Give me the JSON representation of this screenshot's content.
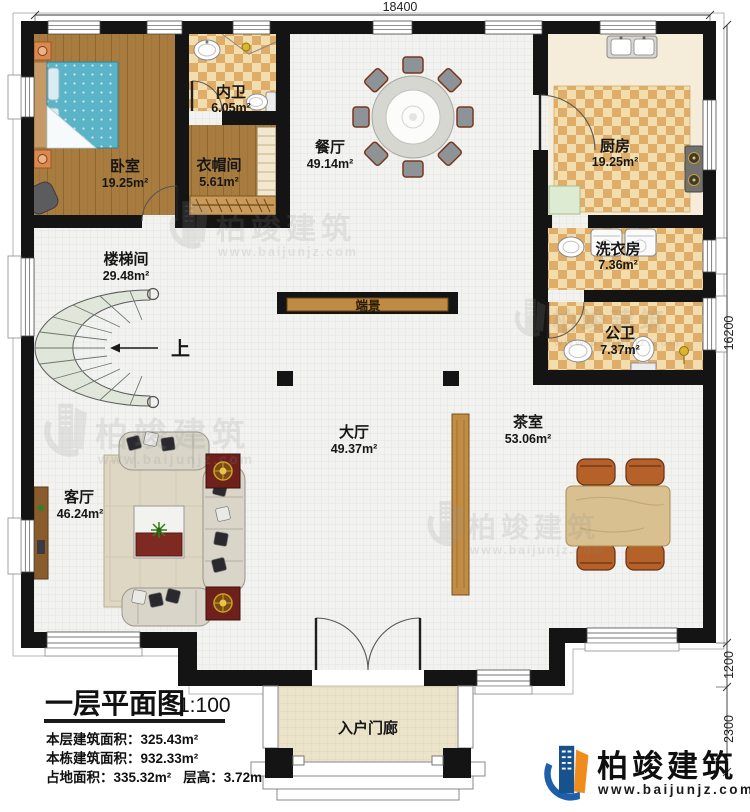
{
  "title_block": {
    "title": "一层平面图",
    "scale": "1:100",
    "stat1_label": "本层建筑面积：",
    "stat1_value": "325.43m²",
    "stat2_label": "本栋建筑面积：",
    "stat2_value": "932.33m²",
    "stat3_label": "占地面积：",
    "stat3_value": "335.32m²",
    "stat4_label": "层高：",
    "stat4_value": "3.72m"
  },
  "rooms": [
    {
      "key": "bedroom",
      "name": "卧室",
      "area": "19.25m²"
    },
    {
      "key": "ensuite-bath",
      "name": "内卫",
      "area": "6.05m²"
    },
    {
      "key": "cloakroom",
      "name": "衣帽间",
      "area": "5.61m²"
    },
    {
      "key": "dining-room",
      "name": "餐厅",
      "area": "49.14m²"
    },
    {
      "key": "kitchen",
      "name": "厨房",
      "area": "19.25m²"
    },
    {
      "key": "laundry-room",
      "name": "洗衣房",
      "area": "7.36m²"
    },
    {
      "key": "public-bath",
      "name": "公卫",
      "area": "7.37m²"
    },
    {
      "key": "stairwell",
      "name": "楼梯间",
      "area": "29.48m²"
    },
    {
      "key": "hall",
      "name": "大厅",
      "area": "49.37m²"
    },
    {
      "key": "tea-room",
      "name": "茶室",
      "area": "53.06m²"
    },
    {
      "key": "living-room",
      "name": "客厅",
      "area": "46.24m²"
    },
    {
      "key": "feature-wall",
      "name": "端景",
      "area": ""
    },
    {
      "key": "entry-porch",
      "name": "入户门廊",
      "area": ""
    }
  ],
  "labels": {
    "stairs_up": "上"
  },
  "dims": {
    "top": "18400",
    "right_total": "16200",
    "right_step": "1200",
    "right_porch": "2300"
  },
  "brand": {
    "name": "柏竣建筑",
    "url": "www.baijunjz.com"
  },
  "watermark": {
    "name": "柏竣建筑",
    "url": "www.baijunjz.com"
  },
  "colors": {
    "wall": "#141414",
    "wood_floor": "#a87c3f",
    "tile_light": "#f2ddae",
    "tile_dark": "#dfad68",
    "stair_fill": "#e0e6da",
    "console_wood": "#bf8a43",
    "brand_blue": "#1d5fa8",
    "brand_orange": "#f08c1c",
    "bed_teal": "#5ab3c7",
    "table_red": "#7e2a22"
  }
}
